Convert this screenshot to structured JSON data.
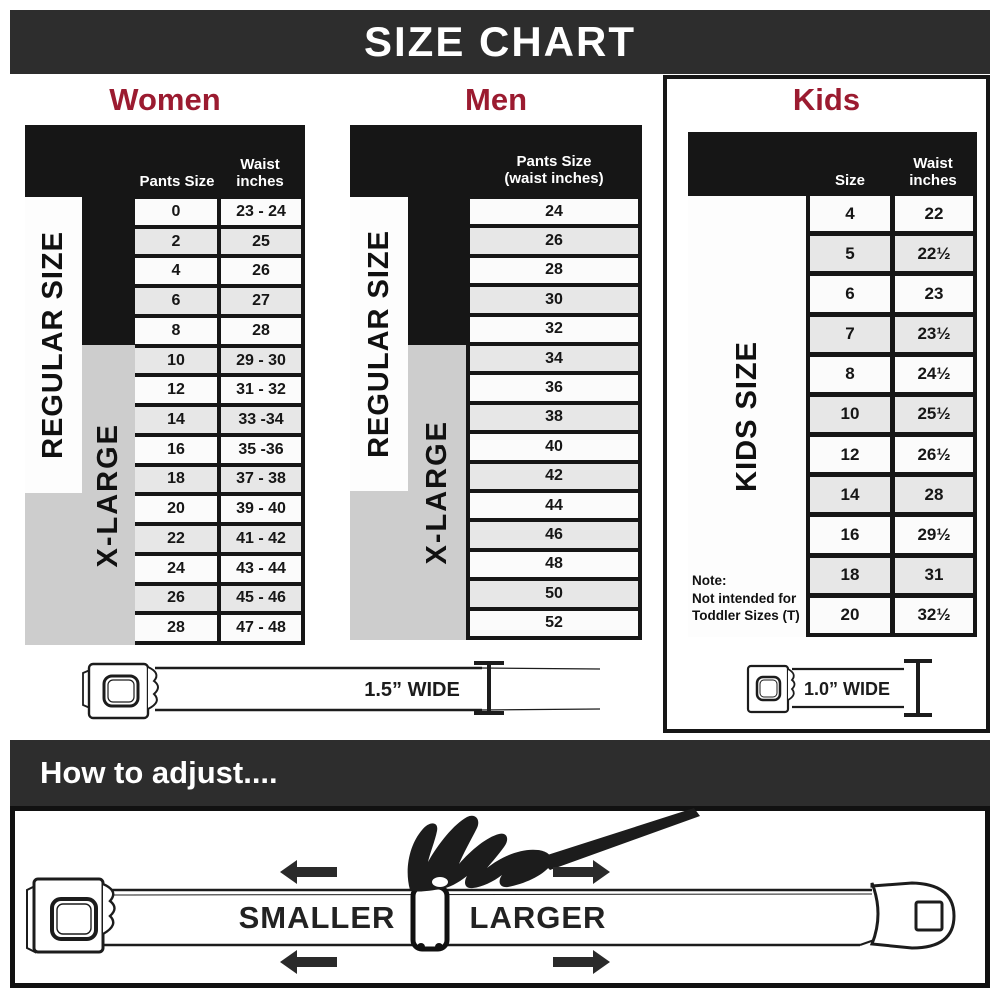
{
  "header": {
    "title": "SIZE CHART"
  },
  "sections": {
    "women": {
      "title": "Women"
    },
    "men": {
      "title": "Men"
    },
    "kids": {
      "title": "Kids"
    }
  },
  "tables": {
    "women": {
      "col1_label": "Pants Size",
      "col2_label": "Waist\ninches",
      "regular_label": "REGULAR SIZE",
      "xlarge_label": "X-LARGE",
      "rows": [
        {
          "size": "0",
          "waist": "23 - 24"
        },
        {
          "size": "2",
          "waist": "25"
        },
        {
          "size": "4",
          "waist": "26"
        },
        {
          "size": "6",
          "waist": "27"
        },
        {
          "size": "8",
          "waist": "28"
        },
        {
          "size": "10",
          "waist": "29 - 30"
        },
        {
          "size": "12",
          "waist": "31 - 32"
        },
        {
          "size": "14",
          "waist": "33 -34"
        },
        {
          "size": "16",
          "waist": "35 -36"
        },
        {
          "size": "18",
          "waist": "37 - 38"
        },
        {
          "size": "20",
          "waist": "39 - 40"
        },
        {
          "size": "22",
          "waist": "41 - 42"
        },
        {
          "size": "24",
          "waist": "43 - 44"
        },
        {
          "size": "26",
          "waist": "45 - 46"
        },
        {
          "size": "28",
          "waist": "47 - 48"
        }
      ]
    },
    "men": {
      "col_label": "Pants Size\n(waist inches)",
      "regular_label": "REGULAR SIZE",
      "xlarge_label": "X-LARGE",
      "rows": [
        "24",
        "26",
        "28",
        "30",
        "32",
        "34",
        "36",
        "38",
        "40",
        "42",
        "44",
        "46",
        "48",
        "50",
        "52"
      ]
    },
    "kids": {
      "col1_label": "Size",
      "col2_label": "Waist\ninches",
      "side_label": "KIDS SIZE",
      "note": "Note:\nNot intended for\nToddler Sizes (T)",
      "rows": [
        {
          "size": "4",
          "waist": "22"
        },
        {
          "size": "5",
          "waist": "22½"
        },
        {
          "size": "6",
          "waist": "23"
        },
        {
          "size": "7",
          "waist": "23½"
        },
        {
          "size": "8",
          "waist": "24½"
        },
        {
          "size": "10",
          "waist": "25½"
        },
        {
          "size": "12",
          "waist": "26½"
        },
        {
          "size": "14",
          "waist": "28"
        },
        {
          "size": "16",
          "waist": "29½"
        },
        {
          "size": "18",
          "waist": "31"
        },
        {
          "size": "20",
          "waist": "32½"
        }
      ]
    }
  },
  "belts": {
    "adult_width_label": "1.5” WIDE",
    "kids_width_label": "1.0” WIDE"
  },
  "adjust": {
    "heading": "How to adjust....",
    "smaller_label": "SMALLER",
    "larger_label": "LARGER"
  },
  "colors": {
    "accent_red": "#9B1B30",
    "band_dark": "#2D2D2D",
    "table_bg": "#161616",
    "cell_alt": "#E7E7E7",
    "block_gray": "#CDCDCD"
  }
}
